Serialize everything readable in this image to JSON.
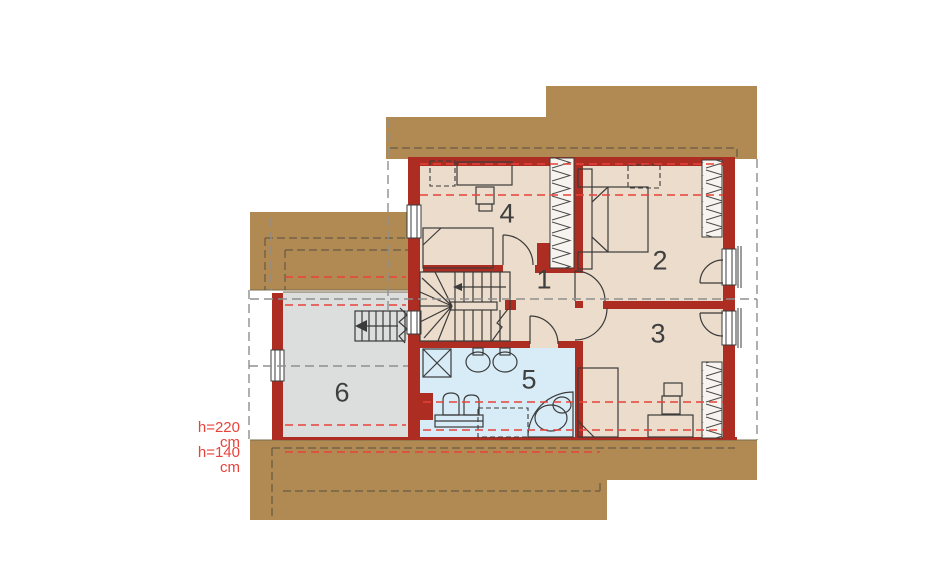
{
  "plan": {
    "type": "attic floor plan",
    "room_labels": [
      {
        "number": "1"
      },
      {
        "number": "2"
      },
      {
        "number": "3"
      },
      {
        "number": "4"
      },
      {
        "number": "5"
      },
      {
        "number": "6"
      }
    ],
    "height_annotations": {
      "line_220": "h=220 cm",
      "line_140": "h=140 cm"
    }
  },
  "colors": {
    "wall_red": "#ad2d22",
    "roof_tan": "#b08a52",
    "floor_beige": "#ecdccb",
    "bathroom_blue": "#d8ecf7",
    "room6_gray": "#dcdddd",
    "height_line_red": "#e8423a",
    "section_line_gray": "#8f8f8f",
    "drawing_line": "#3b3b3b"
  }
}
